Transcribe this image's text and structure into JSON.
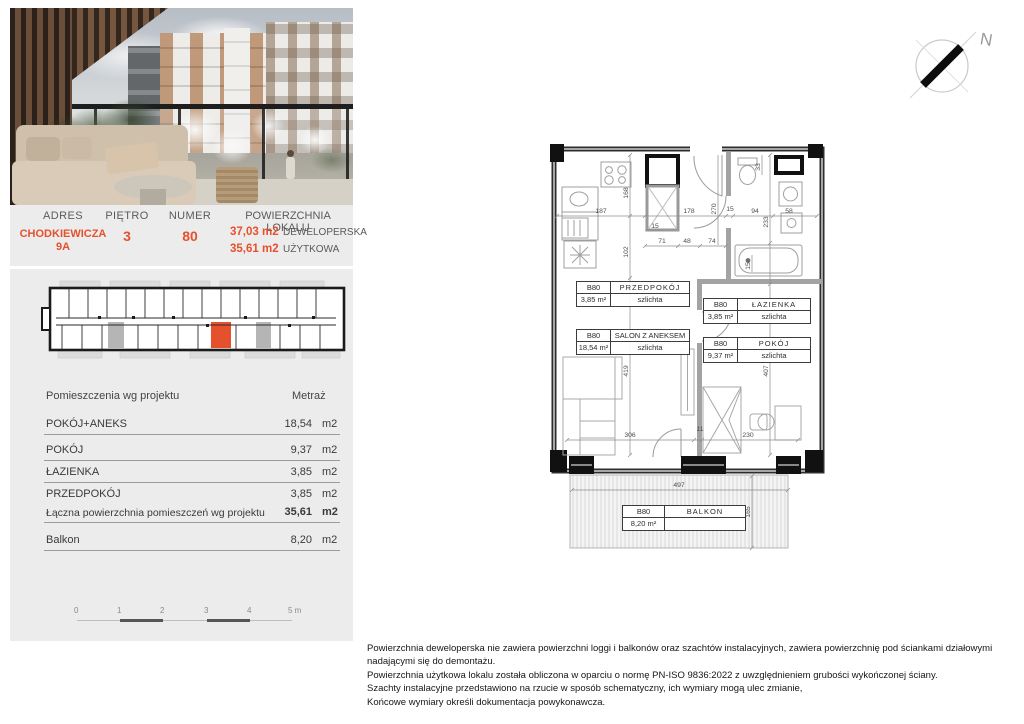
{
  "colors": {
    "accent": "#e5512c",
    "panel": "#ececec"
  },
  "header": {
    "address_label": "ADRES",
    "address_line1": "CHODKIEWICZA",
    "address_line2": "9A",
    "floor_label": "PIĘTRO",
    "floor_value": "3",
    "number_label": "NUMER",
    "number_value": "80",
    "area_label": "POWIERZCHNIA LOKALU",
    "area_rows": [
      {
        "value": "37,03 m2",
        "type": "DEWELOPERSKA"
      },
      {
        "value": "35,61 m2",
        "type": "UŻYTKOWA"
      }
    ]
  },
  "rooms_table": {
    "col_name": "Pomieszczenia wg projektu",
    "col_metric": "Metraż",
    "rows": [
      {
        "name": "POKÓJ+ANEKS",
        "value": "18,54",
        "unit": "m2"
      },
      {
        "name": "POKÓJ",
        "value": "9,37",
        "unit": "m2"
      },
      {
        "name": "ŁAZIENKA",
        "value": "3,85",
        "unit": "m2"
      },
      {
        "name": "PRZEDPOKÓJ",
        "value": "3,85",
        "unit": "m2"
      }
    ],
    "total": {
      "name": "Łączna powierzchnia pomieszczeń wg projektu",
      "value": "35,61",
      "unit": "m2"
    },
    "extra": {
      "name": "Balkon",
      "value": "8,20",
      "unit": "m2"
    }
  },
  "scalebar": {
    "ticks": [
      "0",
      "1",
      "2",
      "3",
      "4",
      "5 m"
    ]
  },
  "floorplan": {
    "tags": [
      {
        "id": "B80",
        "name": "PRZEDPOKÓJ",
        "area": "3,85 m²",
        "finish": "szlichta"
      },
      {
        "id": "B80",
        "name": "ŁAZIENKA",
        "area": "3,85 m²",
        "finish": "szlichta"
      },
      {
        "id": "B80",
        "name": "SALON Z ANEKSEM",
        "area": "18,54 m²",
        "finish": "szlichta"
      },
      {
        "id": "B80",
        "name": "POKÓJ",
        "area": "9,37 m²",
        "finish": "szlichta"
      },
      {
        "id": "B80",
        "name": "BALKON",
        "area": "8,20 m²",
        "finish": ""
      }
    ],
    "dims": [
      "187",
      "168",
      "178",
      "270",
      "15",
      "94",
      "58",
      "33",
      "233",
      "71",
      "48",
      "74",
      "102",
      "15",
      "15",
      "419",
      "407",
      "306",
      "11",
      "230",
      "497",
      "165"
    ]
  },
  "compass": {
    "north": "N"
  },
  "footnotes": [
    "Powierzchnia deweloperska nie zawiera powierzchni loggi i balkonów oraz szachtów instalacyjnych, zawiera powierzchnię pod ściankami działowymi",
    "nadającymi się do demontażu.",
    "Powierzchnia użytkowa lokalu została obliczona w oparciu o normę PN-ISO 9836:2022 z uwzględnieniem grubości wykończonej ściany.",
    "Szachty instalacyjne przedstawiono na rzucie w sposób schematyczny, ich wymiary mogą ulec zmianie,",
    "Końcowe wymiary określi dokumentacja powykonawcza."
  ]
}
